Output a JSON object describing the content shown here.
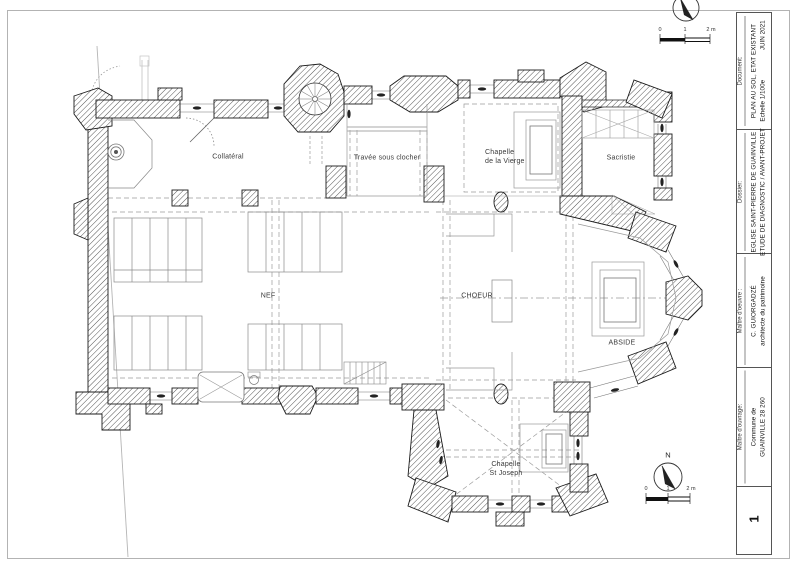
{
  "title_block": {
    "document": {
      "label": "Document:",
      "title": "PLAN AU SOL, ETAT EXISTANT",
      "scale": "Echelle 1/100e",
      "date": "JUIN 2021"
    },
    "dossier": {
      "label": "Dossier:",
      "line1": "EGLISE SAINT-PIERRE DE GUAINVILLE",
      "line2": "ETUDE DE DIAGNOSTIC / AVANT-PROJET"
    },
    "moe": {
      "label": "Maître d'oeuvre :",
      "line1": "C. GUIORGADZÉ",
      "line2": "architecte du patrimoine"
    },
    "moa": {
      "label": "Maître d'ouvrage:",
      "line1": "Commune de",
      "line2": "GUAINVILLE 28 260"
    },
    "page": "1"
  },
  "plan": {
    "rooms": {
      "collateral": "Collatéral",
      "travee": "Travée sous clocher",
      "vierge1": "Chapelle",
      "vierge2": "de la Vierge",
      "sacristie": "Sacristie",
      "nef": "NEF",
      "choeur": "CHOEUR",
      "abside": "ABSIDE",
      "joseph1": "Chapelle",
      "joseph2": "St Joseph"
    },
    "north": "N",
    "scale": {
      "t0": "0",
      "t1": "1",
      "t2": "2 m"
    }
  },
  "colors": {
    "wall_outline": "#1b1b1b",
    "hatch": "#555555",
    "light_line": "#999999",
    "dash_line": "#9a9a9a",
    "boundary": "#b5b5b5"
  }
}
